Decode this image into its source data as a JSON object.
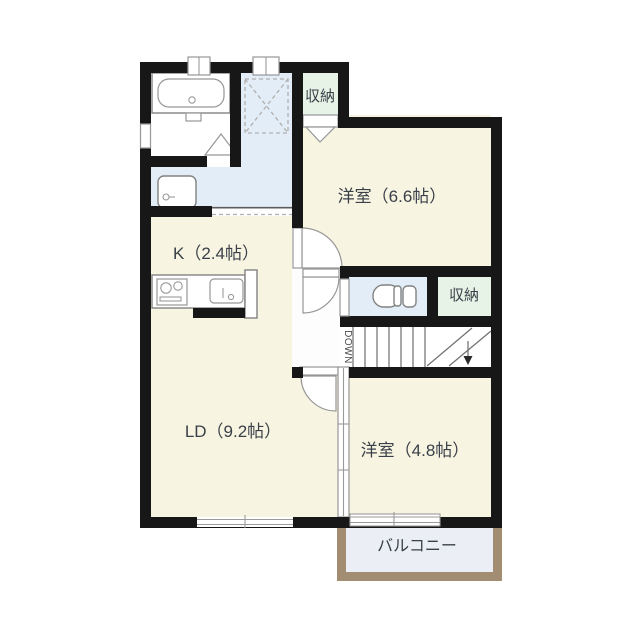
{
  "plan": {
    "type": "floorplan",
    "rooms": {
      "closet_top": {
        "label": "収納"
      },
      "western_room_1": {
        "label": "洋室（6.6帖）"
      },
      "kitchen": {
        "label": "K（2.4帖）"
      },
      "closet_side": {
        "label": "収納"
      },
      "stairs": {
        "label": "DOWN"
      },
      "living_dining": {
        "label": "LD（9.2帖）"
      },
      "western_room_2": {
        "label": "洋室（4.8帖）"
      },
      "balcony": {
        "label": "バルコニー"
      }
    },
    "colors": {
      "room_floor": "#f8f4e2",
      "hall_floor": "#e3edf7",
      "closet_floor": "#e6f3e6",
      "corridor_floor": "#fdfdfd",
      "stairs_floor": "#ffffff",
      "balcony_floor": "#eceef5",
      "balcony_wall": "#a28c72",
      "wall": "#171717",
      "label_text": "#3a4049"
    }
  }
}
